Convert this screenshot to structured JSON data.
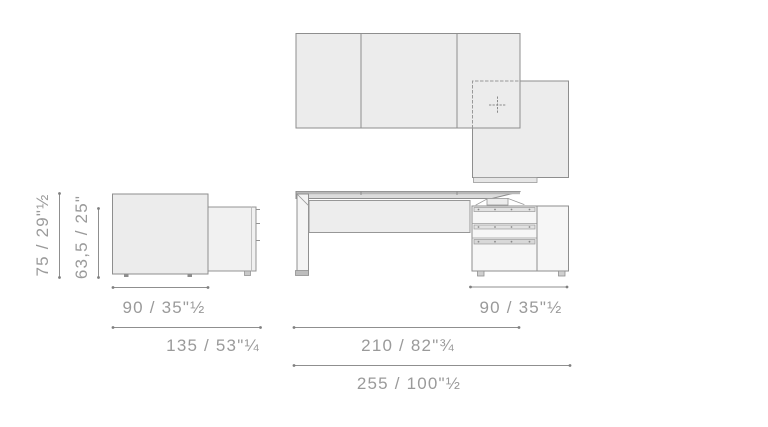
{
  "drawing_title": "executive-desk-with-return-dimension-drawing",
  "colors": {
    "background": "#ffffff",
    "panel_fill": "#ececec",
    "front_fill": "#f6f6f6",
    "desktop_fill": "#d6d6d6",
    "outline": "#8e8e8e",
    "dimension_line": "#8f8f8f",
    "dimension_text": "#9a9a9a"
  },
  "dimensions": {
    "height_total": "75 / 29\"½",
    "height_clearance": "63,5 / 25\"",
    "depth_desktop": "90 / 35\"½",
    "depth_total": "135 / 53\"¼",
    "width_return": "90 / 35\"½",
    "width_desktop": "210 / 82\"¾",
    "width_total": "255 / 100\"½"
  },
  "icons": {
    "move_crosshair": "dotted-cross"
  }
}
